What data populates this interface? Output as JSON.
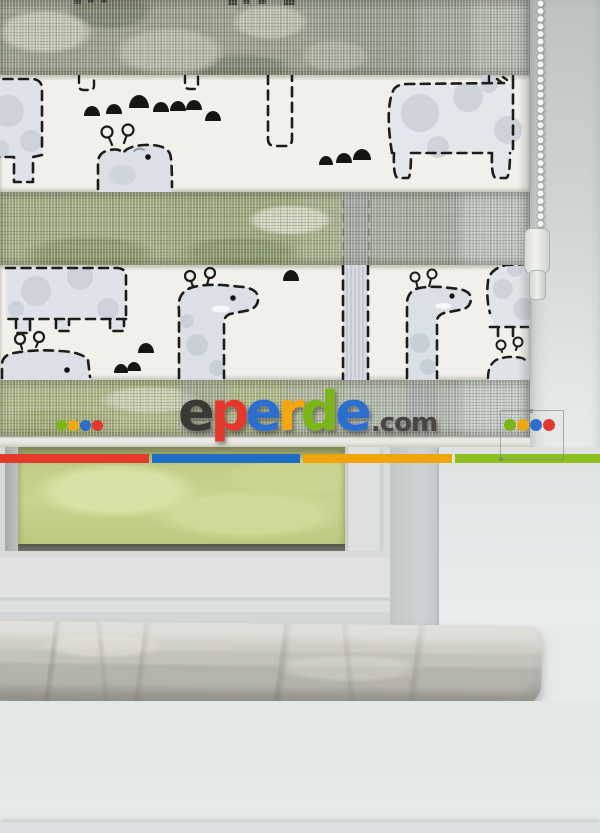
{
  "watermark": {
    "brand": "eperde",
    "letters": [
      {
        "ch": "e",
        "color": "#3b3835"
      },
      {
        "ch": "p",
        "color": "#e5372b"
      },
      {
        "ch": "e",
        "color": "#2a6fd0"
      },
      {
        "ch": "r",
        "color": "#f5a60a"
      },
      {
        "ch": "d",
        "color": "#7ab615"
      },
      {
        "ch": "e",
        "color": "#2a6fd0"
      }
    ],
    "suffix": ".com",
    "suffix_color": "#4a4543",
    "dots_left": [
      "#7ab615",
      "#f0a80c",
      "#2a6fd0",
      "#e5372b"
    ],
    "dots_right": [
      "#7ab615",
      "#f0a80c",
      "#2a6fd0",
      "#e5372b"
    ]
  },
  "brand_bar": {
    "segments": [
      {
        "name": "red",
        "color": "#e23b2c"
      },
      {
        "name": "blue",
        "color": "#1e6fc3"
      },
      {
        "name": "yellow",
        "color": "#f0a60b"
      },
      {
        "name": "green",
        "color": "#8cc021"
      }
    ]
  },
  "palette": {
    "blind_fabric": "#f1f0ea",
    "animal_fill": "#dde1e7",
    "animal_spot": "#c9ced6",
    "pattern_outline": "#1c1c1a",
    "sheer_grass": "#9cab7e",
    "window_grass": "#c7d38f",
    "window_frame": "#dde0df",
    "gasket": "#55574d",
    "sill_stone": "#b5b4ac",
    "wall": "#e6e9ea"
  }
}
